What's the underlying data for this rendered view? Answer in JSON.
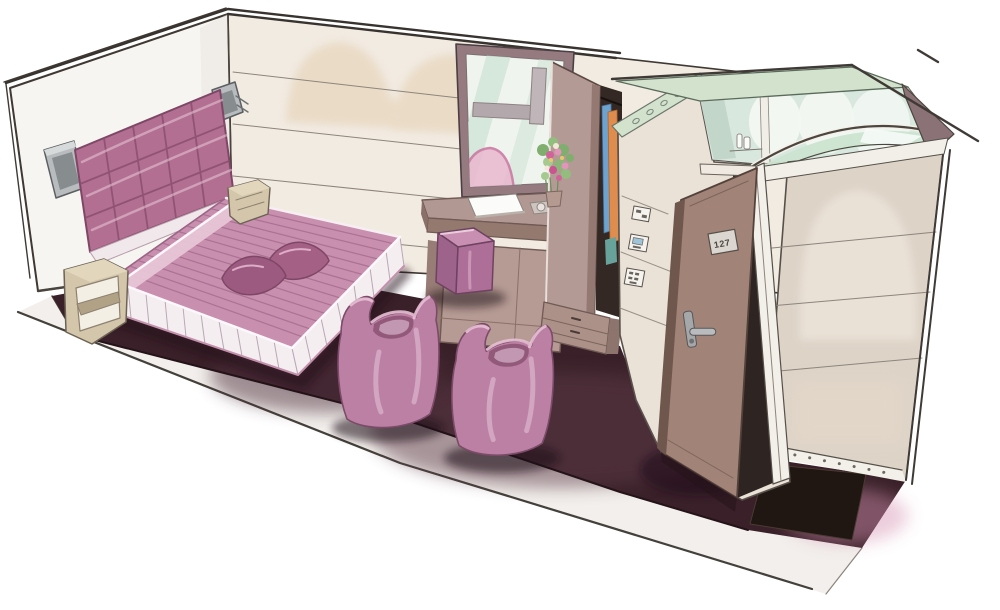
{
  "meta": {
    "type": "interior-design-illustration",
    "subject": "hotel guest room",
    "technique": "hand-drawn marker perspective sketch",
    "view": "aerial cutaway from above-left"
  },
  "door": {
    "plate_number": "127"
  },
  "inventory": [
    "double bed with striped bedspread, pleated skirt and two pillows",
    "tufted padded headboard",
    "two wall sconce lamps",
    "two open-cube nightstands",
    "window with garden view and flower bouquet",
    "writing desk with book and dish, cabinet below",
    "pink cube ottoman",
    "two pink tub chairs",
    "open wardrobe with hanging clothes and drawer base",
    "bathroom cube with glass roof, ceiling spots and arched glass screen",
    "light-switch panels",
    "open entry door with number plate and lever handle",
    "dark entry mat on plum carpet"
  ],
  "palette": {
    "left_wall": "#f7f5f1",
    "back_wall": "#f2ebe2",
    "right_wall": "#ddd3c7",
    "bath_wall": "#eae2d7",
    "arch_wash": "#e7d6bd",
    "carpet": "#3a2129",
    "carpet_light": "#5d3a47",
    "floor_slab": "#f2efec",
    "mat": "#201612",
    "outline": "#3f3833",
    "headboard": "#b26f91",
    "bedspread": "#c98fae",
    "bed_fold": "#e8c8d7",
    "skirt": "#f4eef1",
    "pillow": "#a56086",
    "chair": "#bc80a5",
    "chair_seat": "#8e5476",
    "chair_rim": "#e7c0d4",
    "ottoman_top": "#c98fb2",
    "ottoman_side": "#ad6f97",
    "desk": "#b29893",
    "desk_dark": "#94796f",
    "cabinet": "#b59b93",
    "closet_door": "#b49a95",
    "closet_interior": "#332824",
    "drawer_unit": "#ac9189",
    "door_leaf": "#a28377",
    "door_edge": "#6f574e",
    "nightstand": "#d3c6aa",
    "sconce": "#b9bcbe",
    "metal": "#a5a7a9",
    "window_frame": "#957a80",
    "window_glass": "#eff4ee",
    "glass_mint": "#cfe3d6",
    "roof_glass": "#d3e2cd",
    "screen_glass": "#cbe4d0",
    "interior_mint": "#d9e8de",
    "wedge": "#8b7276",
    "clothes_blue": "#6fa3cf",
    "clothes_orange": "#df8c4f",
    "clothes_teal": "#68a39b",
    "flower_pink": "#d2639a",
    "leaf_green": "#7fae6e",
    "pink_fade": "#d592b1"
  }
}
